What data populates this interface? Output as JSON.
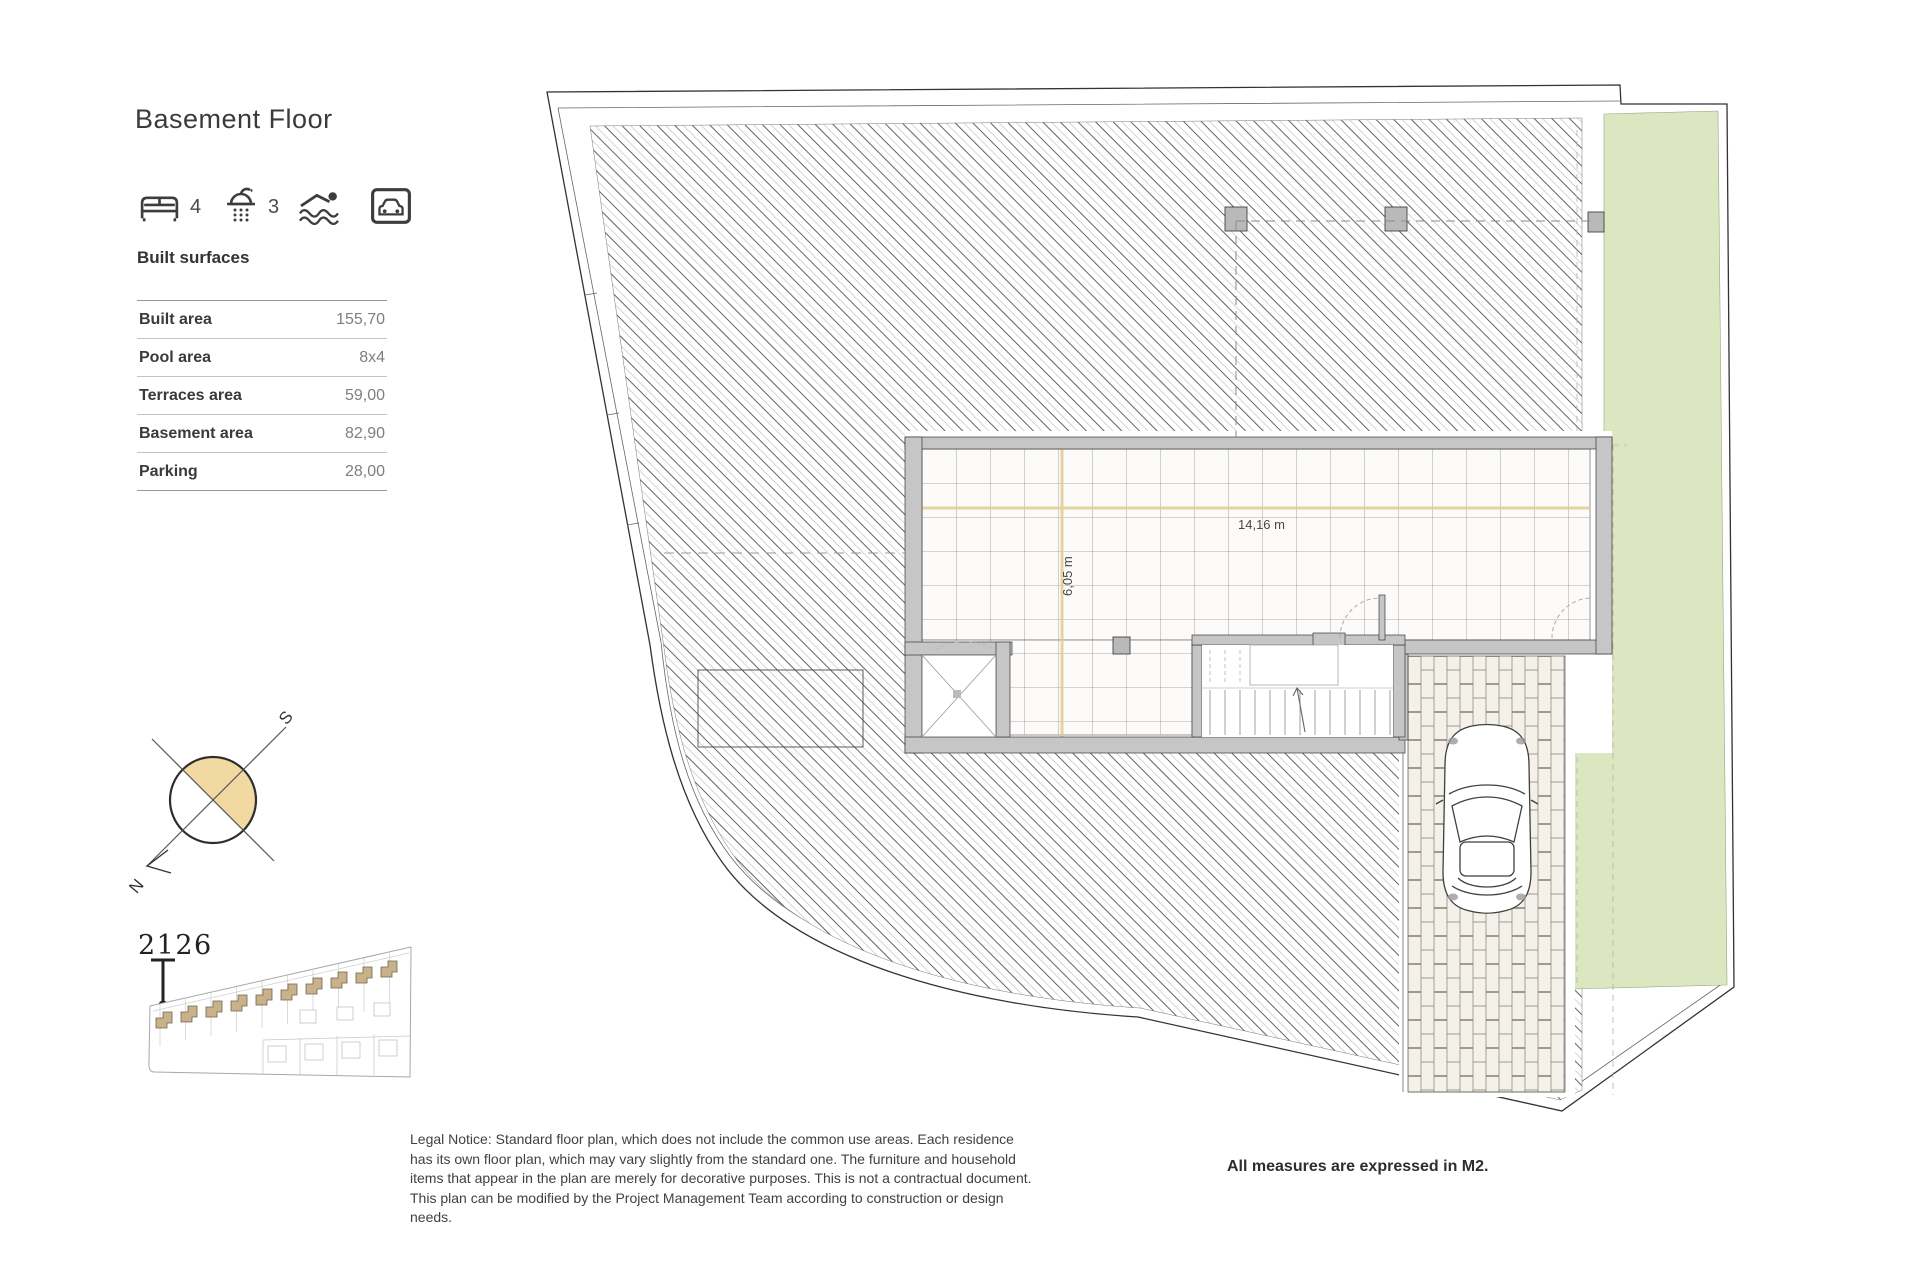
{
  "header": {
    "title": "Basement Floor"
  },
  "amenities": {
    "beds_count": "4",
    "baths_count": "3"
  },
  "surfaces": {
    "title": "Built surfaces",
    "rows": [
      {
        "label": "Built area",
        "value": "155,70"
      },
      {
        "label": "Pool area",
        "value": "8x4"
      },
      {
        "label": "Terraces area",
        "value": "59,00"
      },
      {
        "label": "Basement area",
        "value": "82,90"
      },
      {
        "label": "Parking",
        "value": "28,00"
      }
    ]
  },
  "compass": {
    "north": "N",
    "south": "S"
  },
  "site_plan": {
    "unit_number": "2126"
  },
  "plan": {
    "width_dim": "14,16 m",
    "depth_dim": "6,05 m"
  },
  "footer": {
    "legal_notice": "Legal Notice: Standard floor plan, which does not include the common use areas. Each residence has its own floor plan, which may vary slightly from the standard one. The furniture and household items that appear in the plan are merely for decorative purposes. This is not a contractual document. This plan can be modified by the Project Management Team according to construction or design needs.",
    "measures_note": "All measures are expressed in M2."
  },
  "colors": {
    "garden_green": "#dce6c0",
    "dimension_tan": "#e3cd92",
    "house_tan": "#c9b28a",
    "compass_fill": "#f2d9a2",
    "wall_gray": "#c6c6c6"
  }
}
